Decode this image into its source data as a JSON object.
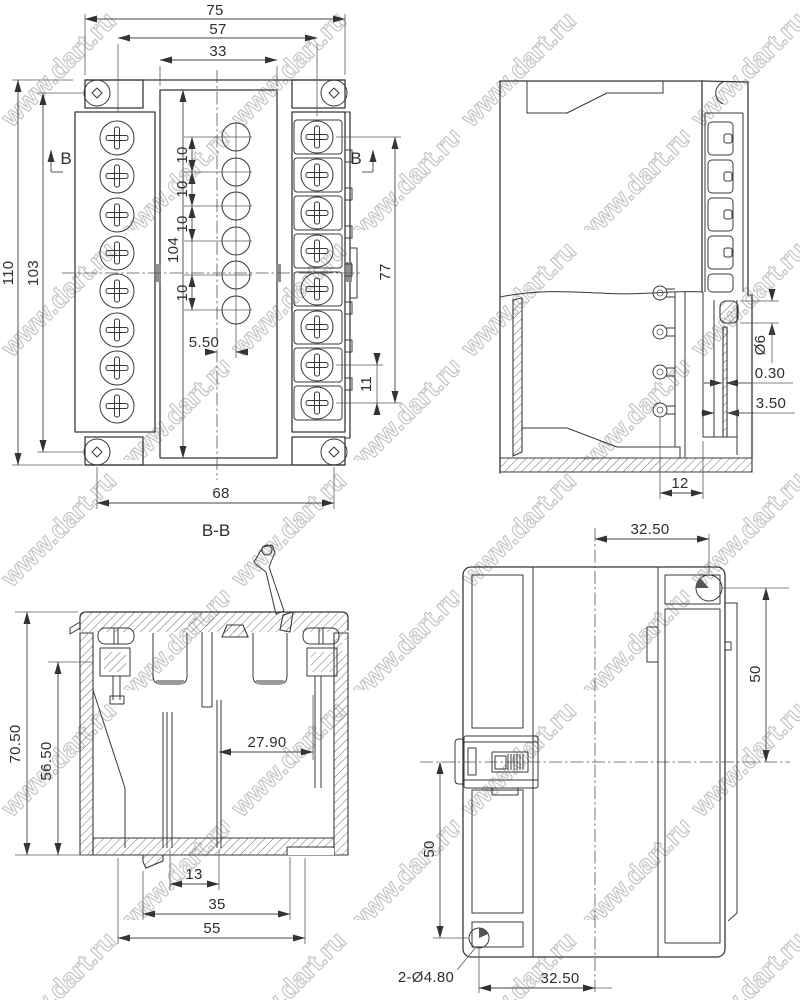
{
  "watermark": {
    "text": "www.dart.ru"
  },
  "colors": {
    "line": "#383838",
    "dimension_text": "#2e2e2e",
    "watermark": "#c6c6c6",
    "background": "#ffffff"
  },
  "views": {
    "front": {
      "section_marker": "B",
      "dims": {
        "w75": "75",
        "w57": "57",
        "w33": "33",
        "h110": "110",
        "h103": "103",
        "h104": "104",
        "pitch10": [
          "10",
          "10",
          "10",
          "10"
        ],
        "off550": "5.50",
        "w68": "68",
        "h77": "77",
        "p11": "11"
      }
    },
    "side": {
      "dims": {
        "d6": "Ø6",
        "t030": "0.30",
        "t350": "3.50",
        "w12": "12"
      }
    },
    "section_bb": {
      "label": "B-B",
      "dims": {
        "h7050": "70.50",
        "h5650": "56.50",
        "w2790": "27.90",
        "w13": "13",
        "w35": "35",
        "w55": "55"
      }
    },
    "bottom": {
      "dims": {
        "top3250": "32.50",
        "right50": "50",
        "left50": "50",
        "holes": "2-Ø4.80",
        "bottom3250": "32.50"
      }
    }
  }
}
